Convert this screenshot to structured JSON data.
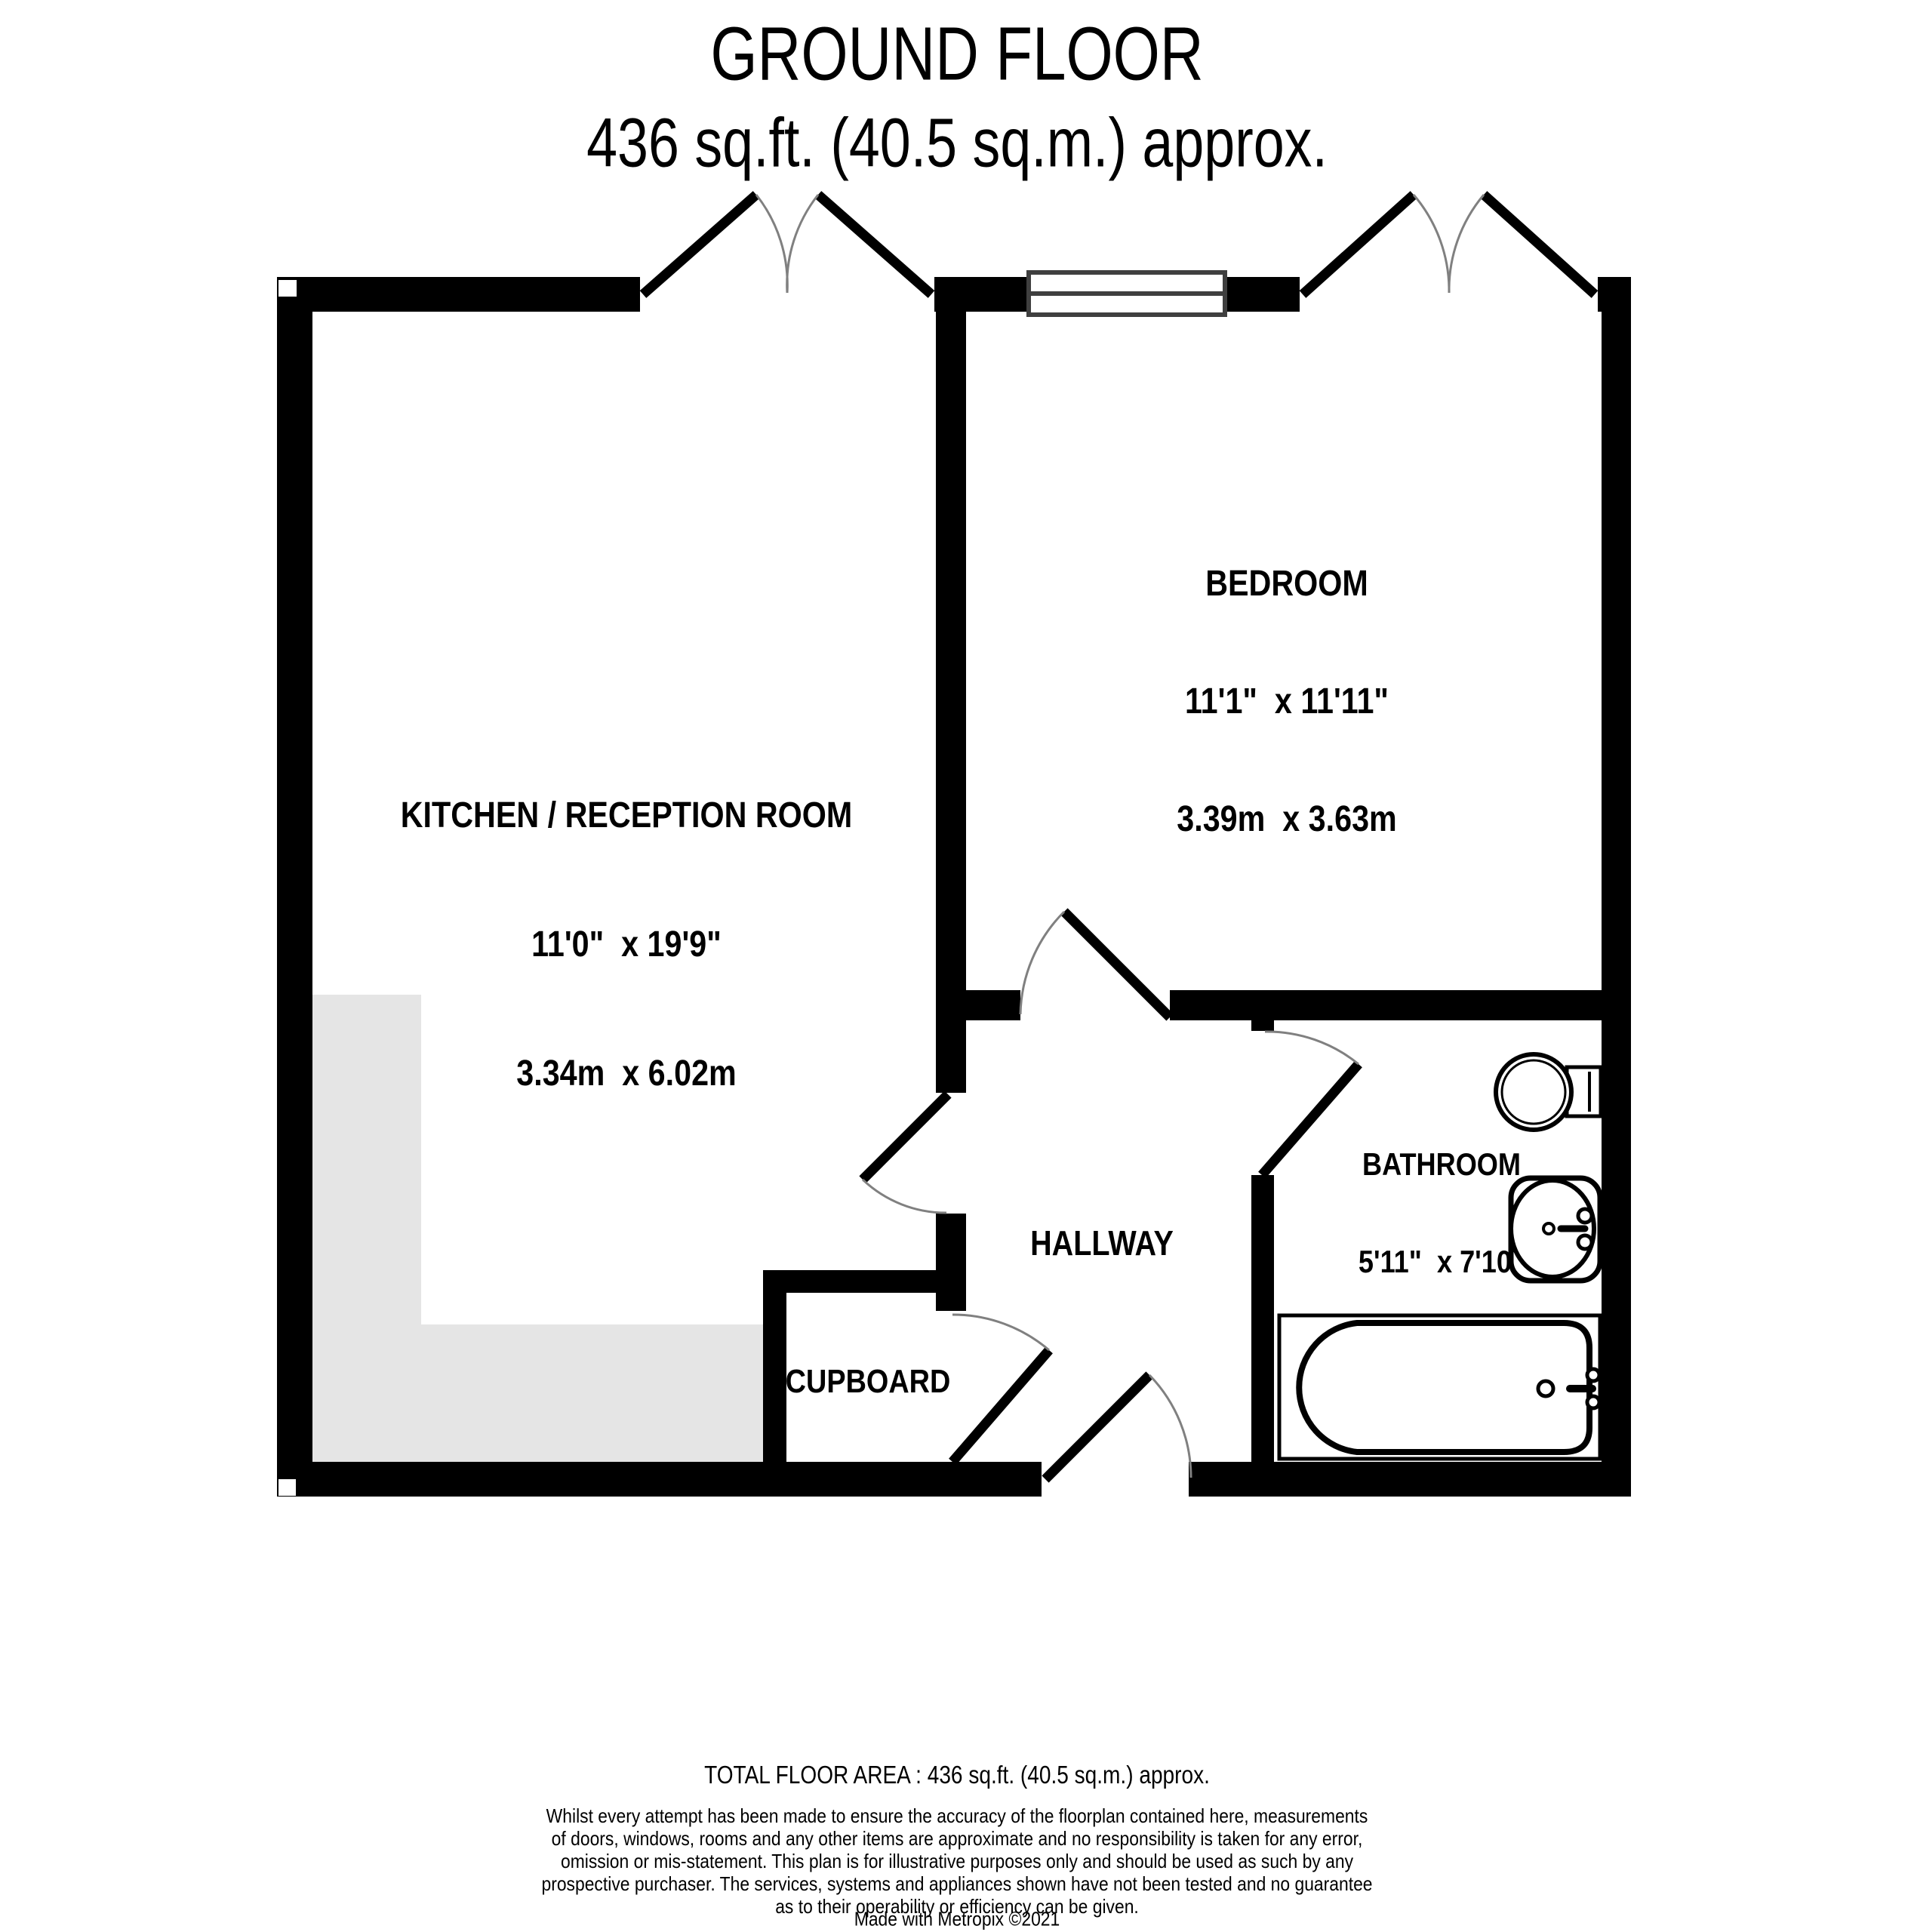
{
  "title": {
    "floor": "GROUND FLOOR",
    "area": "436 sq.ft. (40.5 sq.m.) approx."
  },
  "rooms": {
    "kitchen": {
      "name": "KITCHEN / RECEPTION ROOM",
      "imperial": "11'0\"  x 19'9\"",
      "metric": "3.34m  x 6.02m"
    },
    "bedroom": {
      "name": "BEDROOM",
      "imperial": "11'1\"  x 11'11\"",
      "metric": "3.39m  x 3.63m"
    },
    "bathroom": {
      "name": "BATHROOM",
      "imperial": "5'11\"  x 7'10\"",
      "metric": "1.81m  x 2.39m"
    },
    "hallway": {
      "name": "HALLWAY"
    },
    "cupboard": {
      "name": "CUPBOARD"
    }
  },
  "footer": {
    "total": "TOTAL FLOOR AREA : 436 sq.ft. (40.5 sq.m.) approx.",
    "disclaimer": [
      "Whilst every attempt has been made to ensure the accuracy of the floorplan contained here, measurements",
      "of doors, windows, rooms and any other items are approximate and no responsibility is taken for any error,",
      "omission or mis-statement. This plan is for illustrative purposes only and should be used as such by any",
      "prospective purchaser. The services, systems and appliances shown have not been tested and no guarantee",
      "as to their operability or efficiency can be given."
    ],
    "credit": "Made with Metropix ©2021"
  },
  "colors": {
    "wall": "#000000",
    "kitchen_floor_highlight": "#e5e5e5",
    "door_arc": "#808080",
    "window_frame": "#3f3f3f"
  }
}
